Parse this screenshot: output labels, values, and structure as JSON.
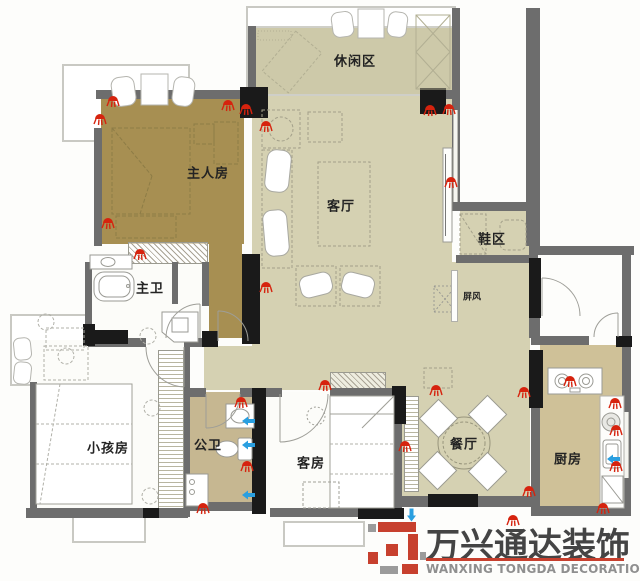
{
  "rooms": {
    "leisure": {
      "label": "休闲区"
    },
    "master": {
      "label": "主人房"
    },
    "living": {
      "label": "客厅"
    },
    "shoe": {
      "label": "鞋区"
    },
    "screen": {
      "label": "屏风"
    },
    "master_bath": {
      "label": "主卫"
    },
    "kids": {
      "label": "小孩房"
    },
    "guest_bath": {
      "label": "公卫"
    },
    "guest": {
      "label": "客房"
    },
    "dining": {
      "label": "餐厅"
    },
    "kitchen": {
      "label": "厨房"
    }
  },
  "watermark": {
    "logo_cn": "万兴通达装饰",
    "logo_en": "WANXING TONGDA DECORATION"
  },
  "colors": {
    "master_floor": "#a78f52",
    "living_floor": "#d5d1b2",
    "leisure_floor": "#cdc9a9",
    "bath_floor": "#c6b791",
    "kitchen_floor": "#cfc198",
    "wall": "#6d6d6d",
    "wall_dark": "#1a1a1a",
    "light_marker": "#d6230e",
    "water_marker": "#2a9fe0",
    "logo_red": "#c7402e"
  },
  "fixtures": {
    "ceiling_lights": [
      [
        113,
        99
      ],
      [
        100,
        117
      ],
      [
        228,
        103
      ],
      [
        246,
        107
      ],
      [
        266,
        124
      ],
      [
        266,
        285
      ],
      [
        108,
        221
      ],
      [
        140,
        252
      ],
      [
        430,
        108
      ],
      [
        449,
        107
      ],
      [
        451,
        180
      ],
      [
        436,
        388
      ],
      [
        241,
        400
      ],
      [
        325,
        383
      ],
      [
        405,
        444
      ],
      [
        524,
        390
      ],
      [
        529,
        489
      ],
      [
        247,
        464
      ],
      [
        203,
        506
      ],
      [
        513,
        518
      ],
      [
        570,
        379
      ],
      [
        615,
        401
      ],
      [
        616,
        428
      ],
      [
        616,
        464
      ],
      [
        603,
        506
      ]
    ],
    "water_points": [
      [
        249,
        416,
        "left"
      ],
      [
        249,
        440,
        "left"
      ],
      [
        249,
        490,
        "left"
      ],
      [
        614,
        454,
        "left"
      ],
      [
        408,
        513,
        "down"
      ]
    ]
  }
}
